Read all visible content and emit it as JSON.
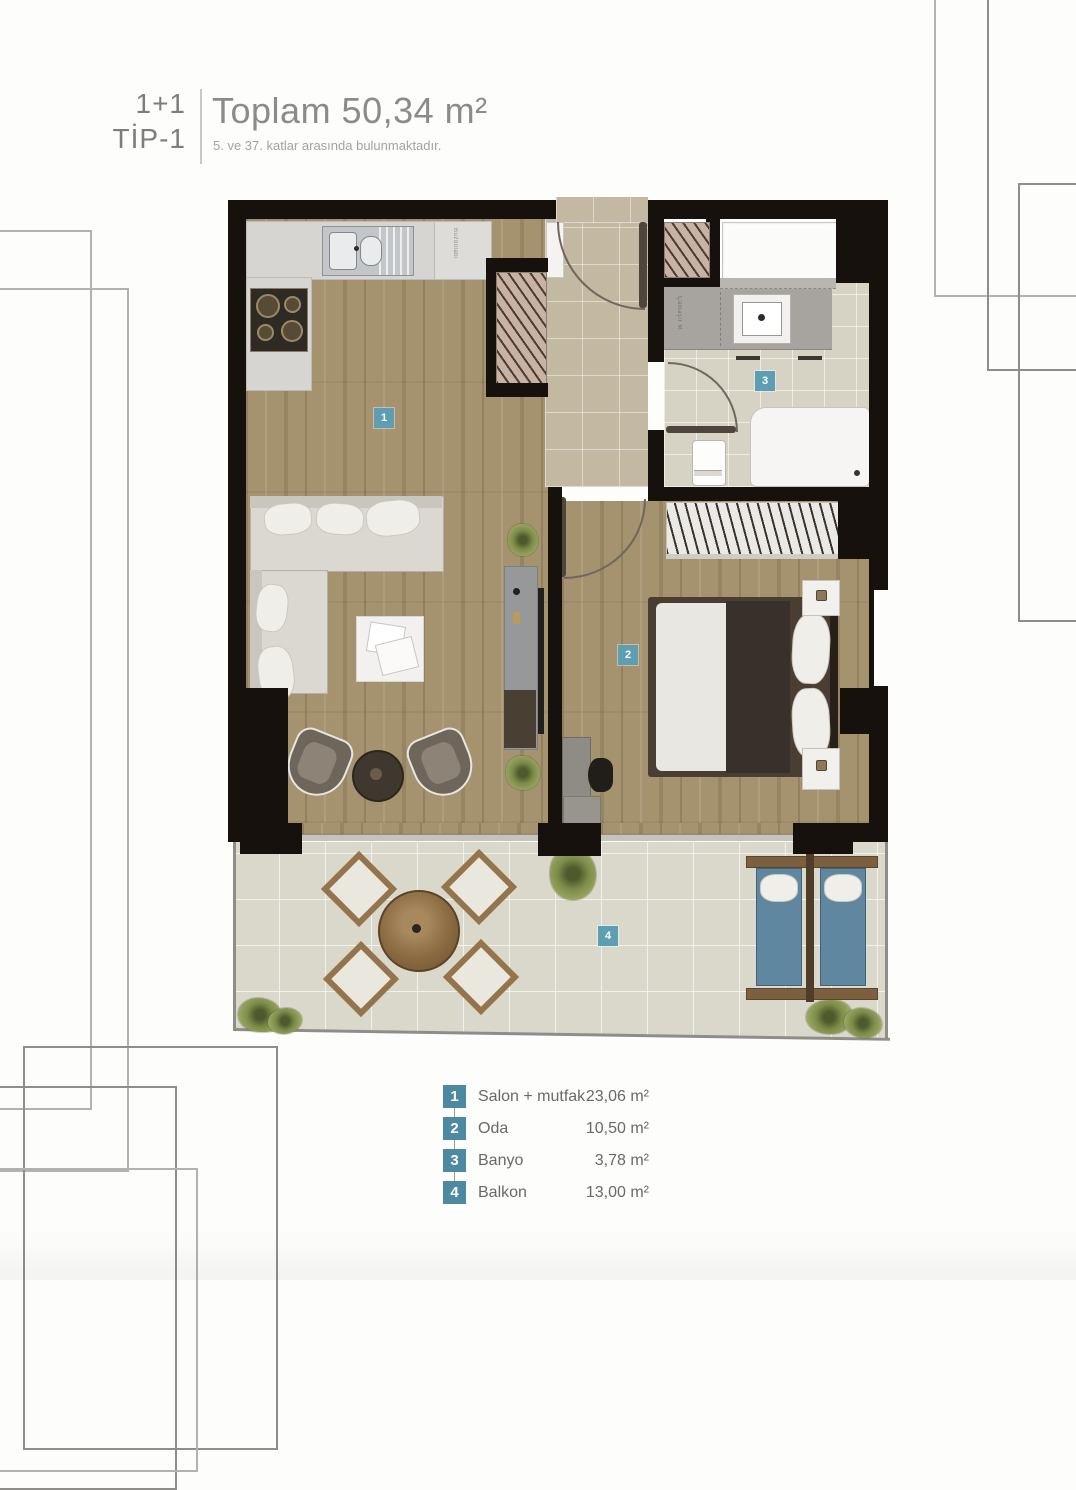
{
  "header": {
    "type_top": "1+1",
    "type_bottom": "TİP-1",
    "title": "Toplam 50,34 m²",
    "subtitle": "5. ve 37. katlar arasında bulunmaktadır."
  },
  "plan": {
    "small_labels": {
      "kitchen_appliance": "Buzdolabı",
      "bath_appliance": "Çamaşır M."
    }
  },
  "legend": {
    "rows": [
      {
        "num": "1",
        "label": "Salon + mutfak",
        "area": "23,06 m²"
      },
      {
        "num": "2",
        "label": "Oda",
        "area": "10,50 m²"
      },
      {
        "num": "3",
        "label": "Banyo",
        "area": "3,78 m²"
      },
      {
        "num": "4",
        "label": "Balkon",
        "area": "13,00 m²"
      }
    ]
  },
  "colors": {
    "badge_teal": "#4d8aa1",
    "plan_badge_teal": "#5e9eb3",
    "wall_black": "#16110d",
    "wood_floor": "#a5926f",
    "hall_tile": "#c3b9a3",
    "balcony_tile": "#dad7cb"
  }
}
